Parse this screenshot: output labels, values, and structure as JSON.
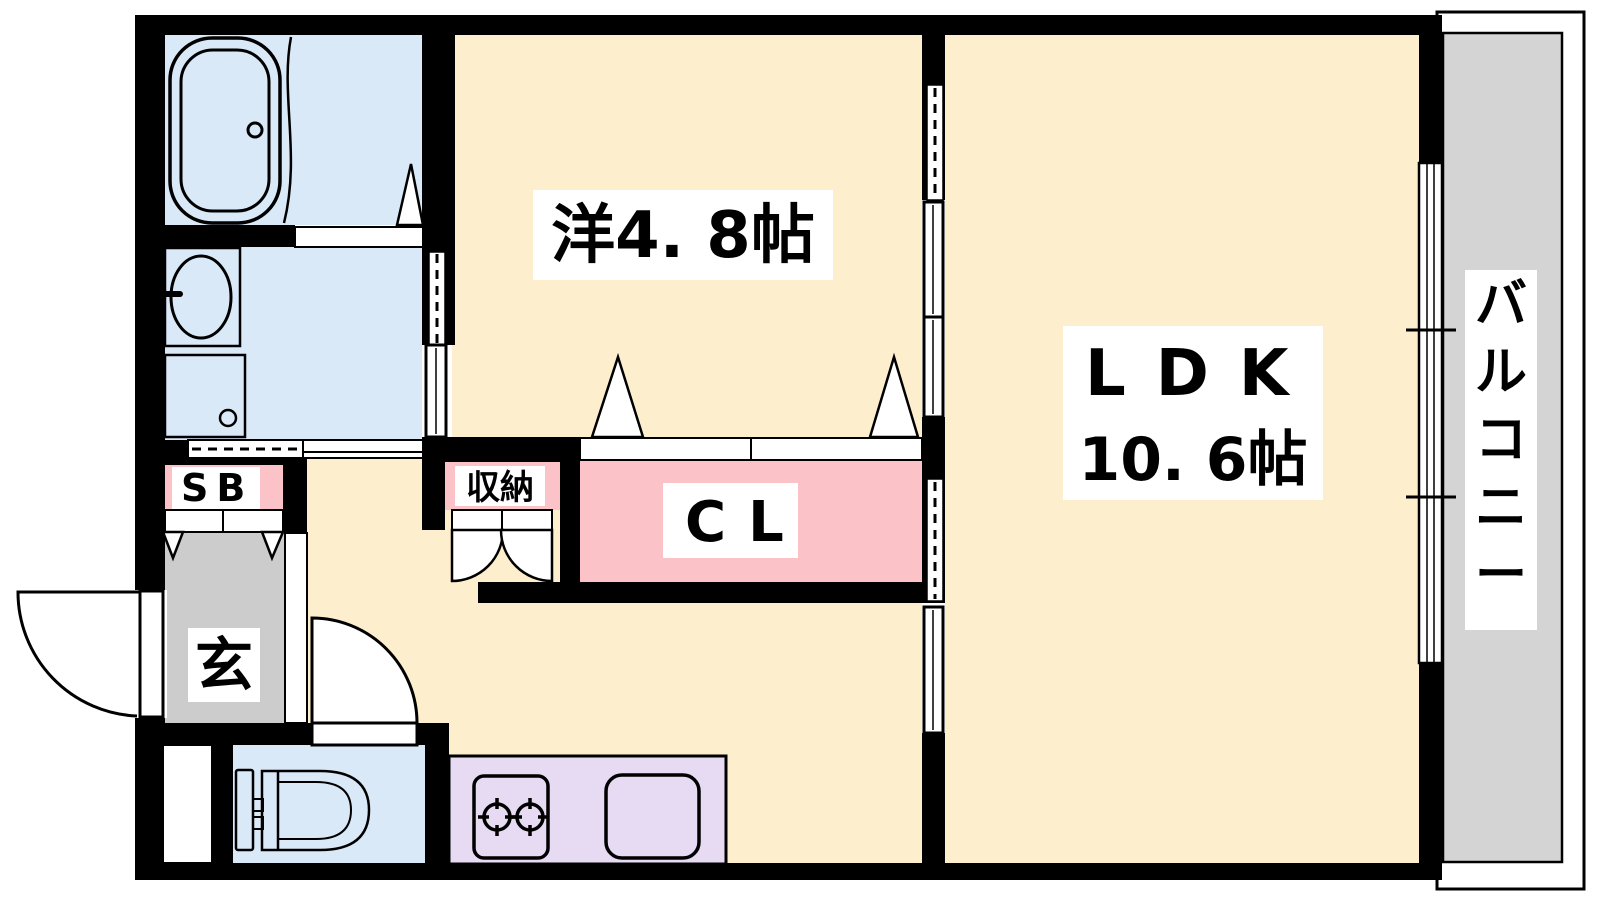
{
  "colors": {
    "wall": "#000000",
    "background": "#ffffff"
  },
  "rooms": {
    "western": {
      "label": "洋4. 8帖",
      "fill": "#fdeecd"
    },
    "ldk": {
      "label": "LDK",
      "size": "10. 6帖",
      "fill": "#fdeecd"
    },
    "hall": {
      "fill": "#fdeecd"
    },
    "closet": {
      "label": "CL",
      "fill": "#fbc3c7"
    },
    "storage": {
      "label": "収納",
      "fill": "#fbc3c7"
    },
    "shoe_box": {
      "label": "SB",
      "fill": "#fbc3c7"
    },
    "entrance": {
      "label": "玄",
      "fill": "#cccccc"
    },
    "balcony": {
      "label": "バルコニー",
      "fill": "#d4d4d4"
    },
    "bathroom": {
      "fill": "#dae9f8"
    },
    "washroom": {
      "fill": "#dae9f8"
    },
    "toilet": {
      "fill": "#dae9f8"
    },
    "kitchen": {
      "fill": "#e7daf3"
    }
  }
}
